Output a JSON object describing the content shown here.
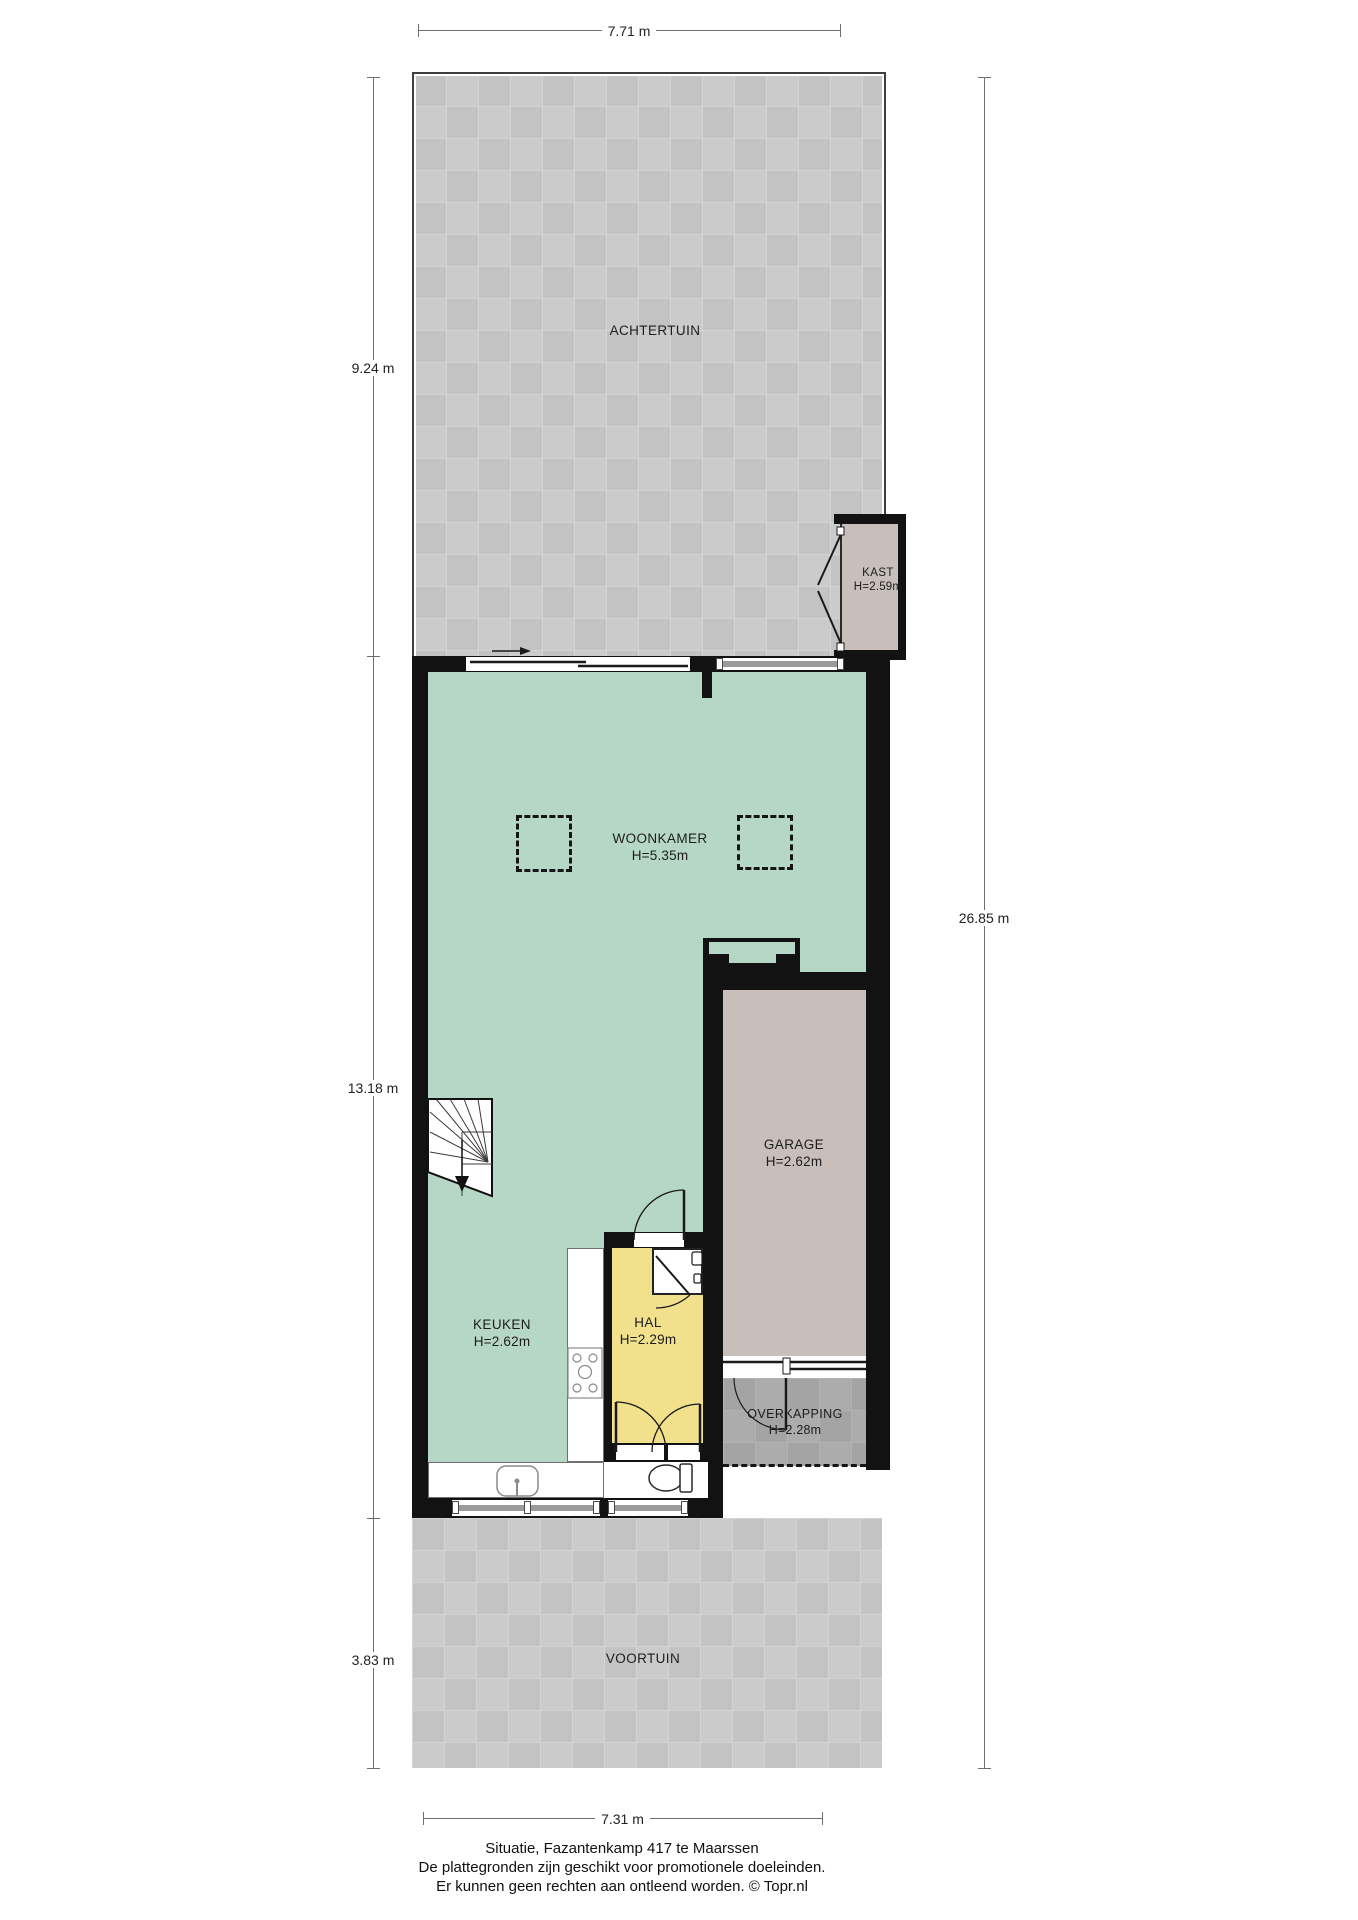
{
  "plan": {
    "title": "Situatie, Fazantenkamp 417 te Maarssen",
    "type": "situation floor plan"
  },
  "rooms": {
    "achtertuin": {
      "label": "ACHTERTUIN"
    },
    "kast": {
      "label": "KAST",
      "height": "H=2.59m"
    },
    "woonkamer": {
      "label": "WOONKAMER",
      "height": "H=5.35m"
    },
    "garage": {
      "label": "GARAGE",
      "height": "H=2.62m"
    },
    "keuken": {
      "label": "KEUKEN",
      "height": "H=2.62m"
    },
    "hal": {
      "label": "HAL",
      "height": "H=2.29m"
    },
    "overkapping": {
      "label": "OVERKAPPING",
      "height": "H=2.28m"
    },
    "voortuin": {
      "label": "VOORTUIN"
    }
  },
  "dimensions": {
    "top": "7.71 m",
    "left_upper": "9.24 m",
    "left_middle": "13.18 m",
    "left_lower": "3.83 m",
    "right": "26.85 m",
    "bottom": "7.31 m"
  },
  "footer": {
    "line1": "Situatie, Fazantenkamp 417 te Maarssen",
    "line2": "De plattegronden zijn geschikt voor promotionele doeleinden.",
    "line3": "Er kunnen geen rechten aan ontleend worden. © Topr.nl"
  },
  "colors": {
    "wall": "#121212",
    "living_floor_green": "#b6d7c5",
    "hall_floor_yellow": "#f1e08c",
    "garage_floor_taupe": "#c8beba",
    "garden_tile_gray": "#c7c7c7",
    "carport_tile_gray": "#a8a8a8",
    "glazing_gray": "#9b9b9b"
  }
}
